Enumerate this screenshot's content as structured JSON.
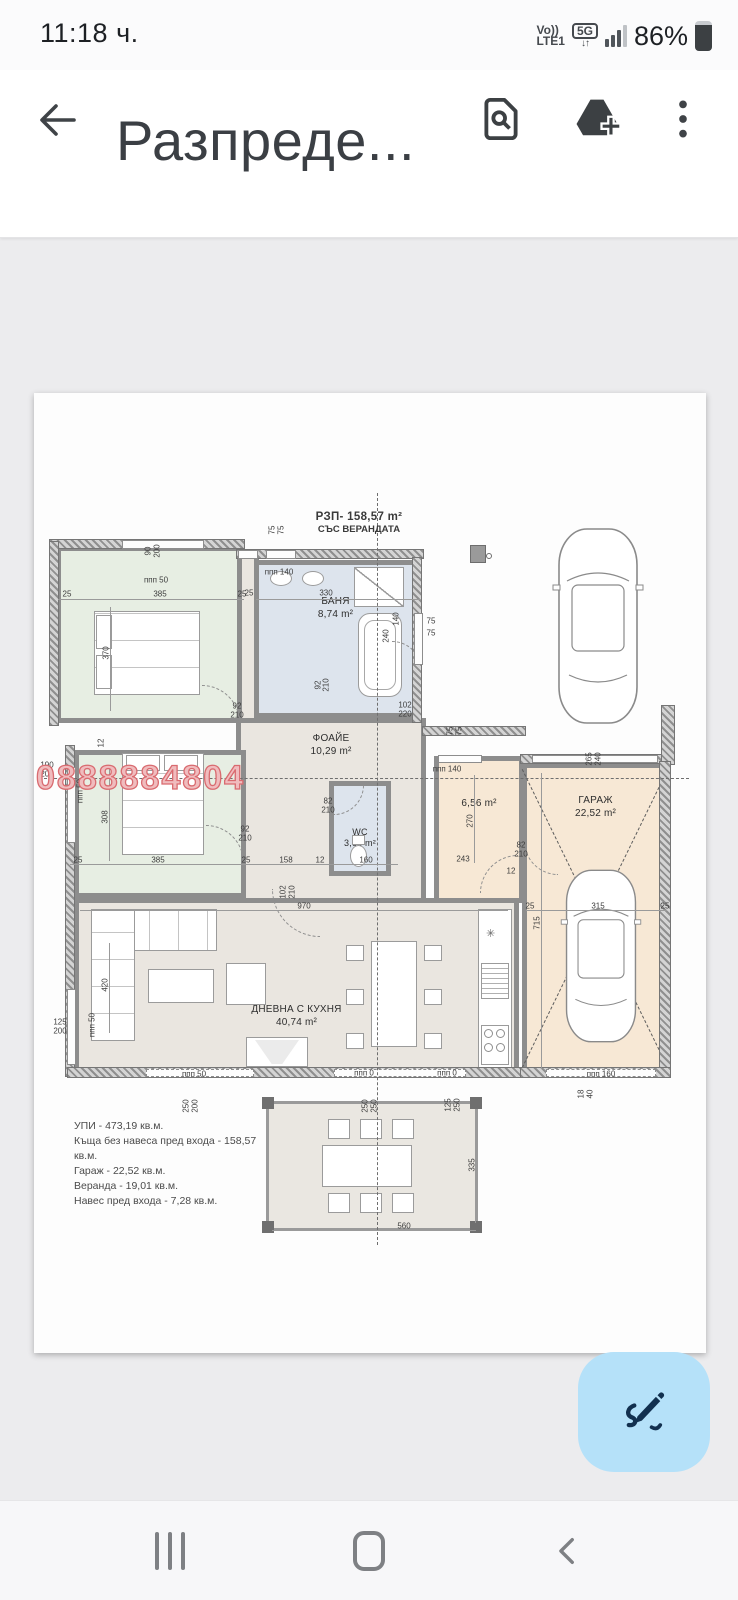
{
  "status_bar": {
    "time": "11:18 ч.",
    "carrier_top": "Vo))",
    "carrier_bottom": "LTE1",
    "network_badge": "5G",
    "updown_arrows": "↓↑",
    "battery_percent": "86%"
  },
  "header": {
    "title": "Разпреде..."
  },
  "colors": {
    "fab_accent": "#b5e1f9",
    "watermark_red": "#d96b70",
    "wall_gray": "#8d8d8d",
    "bedroom_fill": "#e7eee3",
    "bath_fill": "#dde4ed",
    "living_fill": "#eae6e0",
    "garage_fill": "#f7e8d5"
  },
  "plan": {
    "title_line1": "РЗП-  158,57 m²",
    "title_line2": "СЪС ВЕРАНДАТА",
    "watermark": "0888884804",
    "rooms": [
      {
        "id": "bedroom1",
        "lines": [
          "14,25 m²",
          "СПАЛНЯ"
        ]
      },
      {
        "id": "bath",
        "lines": [
          "БАНЯ",
          "8,74 m²"
        ]
      },
      {
        "id": "foyer",
        "lines": [
          "ФОАЙЕ",
          "10,29 m²"
        ]
      },
      {
        "id": "bedroom2",
        "lines": [
          "СПАЛНЯ",
          "11,86 m²"
        ]
      },
      {
        "id": "wc",
        "lines": [
          "WC",
          "3,68 m²"
        ]
      },
      {
        "id": "hall",
        "lines": [
          "6,56 m²"
        ]
      },
      {
        "id": "garage",
        "lines": [
          "ГАРАЖ",
          "22,52 m²"
        ]
      },
      {
        "id": "living",
        "lines": [
          "ДНЕВНА С КУХНЯ",
          "40,74 m²"
        ]
      },
      {
        "id": "veranda",
        "lines": [
          "ВЕРАНДА",
          "19,01 m²"
        ]
      }
    ],
    "summary": [
      "УПИ - 473,19 кв.м.",
      "Къща без навеса пред входа - 158,57 кв.м.",
      "Гараж - 22,52 кв.м.",
      "Веранда - 19,01 кв.м.",
      "Навес пред входа - 7,28 кв.м."
    ],
    "dims": [
      {
        "t": "90",
        "x": 114,
        "y": 158,
        "r": 1
      },
      {
        "t": "200",
        "x": 123,
        "y": 158,
        "r": 1
      },
      {
        "t": "ппп 50",
        "x": 122,
        "y": 187,
        "r": 0
      },
      {
        "t": "25",
        "x": 33,
        "y": 201,
        "r": 0
      },
      {
        "t": "385",
        "x": 126,
        "y": 201,
        "r": 0
      },
      {
        "t": "25",
        "x": 208,
        "y": 201,
        "r": 0
      },
      {
        "t": "370",
        "x": 72,
        "y": 260,
        "r": 1
      },
      {
        "t": "75",
        "x": 238,
        "y": 137,
        "r": 1
      },
      {
        "t": "75",
        "x": 247,
        "y": 137,
        "r": 1
      },
      {
        "t": "ппп 140",
        "x": 245,
        "y": 179,
        "r": 0
      },
      {
        "t": "25",
        "x": 215,
        "y": 200,
        "r": 0
      },
      {
        "t": "330",
        "x": 292,
        "y": 200,
        "r": 0
      },
      {
        "t": "75",
        "x": 397,
        "y": 228,
        "r": 0
      },
      {
        "t": "75",
        "x": 397,
        "y": 240,
        "r": 0
      },
      {
        "t": "240",
        "x": 352,
        "y": 243,
        "r": 1
      },
      {
        "t": "140",
        "x": 362,
        "y": 226,
        "r": 1
      },
      {
        "t": "92",
        "x": 284,
        "y": 292,
        "r": 1
      },
      {
        "t": "210",
        "x": 292,
        "y": 292,
        "r": 1
      },
      {
        "t": "92",
        "x": 203,
        "y": 313,
        "r": 0
      },
      {
        "t": "210",
        "x": 203,
        "y": 322,
        "r": 0
      },
      {
        "t": "102",
        "x": 371,
        "y": 312,
        "r": 0
      },
      {
        "t": "220",
        "x": 371,
        "y": 321,
        "r": 0
      },
      {
        "t": "190",
        "x": 13,
        "y": 372,
        "r": 0
      },
      {
        "t": "200",
        "x": 13,
        "y": 381,
        "r": 0
      },
      {
        "t": "12",
        "x": 67,
        "y": 350,
        "r": 1
      },
      {
        "t": "ппп 50",
        "x": 46,
        "y": 398,
        "r": 1
      },
      {
        "t": "308",
        "x": 71,
        "y": 424,
        "r": 1
      },
      {
        "t": "92",
        "x": 211,
        "y": 436,
        "r": 0
      },
      {
        "t": "210",
        "x": 211,
        "y": 445,
        "r": 0
      },
      {
        "t": "82",
        "x": 294,
        "y": 408,
        "r": 0
      },
      {
        "t": "210",
        "x": 294,
        "y": 417,
        "r": 0
      },
      {
        "t": "25",
        "x": 44,
        "y": 467,
        "r": 0
      },
      {
        "t": "385",
        "x": 124,
        "y": 467,
        "r": 0
      },
      {
        "t": "25",
        "x": 212,
        "y": 467,
        "r": 0
      },
      {
        "t": "158",
        "x": 252,
        "y": 467,
        "r": 0
      },
      {
        "t": "12",
        "x": 286,
        "y": 467,
        "r": 0
      },
      {
        "t": "160",
        "x": 332,
        "y": 467,
        "r": 0
      },
      {
        "t": "ппп 140",
        "x": 413,
        "y": 376,
        "r": 0
      },
      {
        "t": "270",
        "x": 436,
        "y": 428,
        "r": 1
      },
      {
        "t": "243",
        "x": 429,
        "y": 466,
        "r": 0
      },
      {
        "t": "82",
        "x": 487,
        "y": 452,
        "r": 0
      },
      {
        "t": "210",
        "x": 487,
        "y": 461,
        "r": 0
      },
      {
        "t": "12",
        "x": 477,
        "y": 478,
        "r": 0
      },
      {
        "t": "75",
        "x": 416,
        "y": 338,
        "r": 1
      },
      {
        "t": "75",
        "x": 425,
        "y": 338,
        "r": 1
      },
      {
        "t": "265",
        "x": 555,
        "y": 366,
        "r": 1
      },
      {
        "t": "240",
        "x": 564,
        "y": 366,
        "r": 1
      },
      {
        "t": "25",
        "x": 496,
        "y": 513,
        "r": 0
      },
      {
        "t": "315",
        "x": 564,
        "y": 513,
        "r": 0
      },
      {
        "t": "25",
        "x": 631,
        "y": 513,
        "r": 0
      },
      {
        "t": "715",
        "x": 503,
        "y": 530,
        "r": 1
      },
      {
        "t": "970",
        "x": 270,
        "y": 513,
        "r": 0
      },
      {
        "t": "102",
        "x": 249,
        "y": 499,
        "r": 1
      },
      {
        "t": "210",
        "x": 258,
        "y": 499,
        "r": 1
      },
      {
        "t": "420",
        "x": 71,
        "y": 592,
        "r": 1
      },
      {
        "t": "125",
        "x": 26,
        "y": 629,
        "r": 0
      },
      {
        "t": "200",
        "x": 26,
        "y": 638,
        "r": 0
      },
      {
        "t": "ппп 50",
        "x": 58,
        "y": 632,
        "r": 1
      },
      {
        "t": "ппп 50",
        "x": 160,
        "y": 681,
        "r": 0
      },
      {
        "t": "ппп 0",
        "x": 330,
        "y": 680,
        "r": 0
      },
      {
        "t": "ппп 0",
        "x": 413,
        "y": 680,
        "r": 0
      },
      {
        "t": "ппп 160",
        "x": 567,
        "y": 681,
        "r": 0
      },
      {
        "t": "250",
        "x": 152,
        "y": 713,
        "r": 1
      },
      {
        "t": "200",
        "x": 161,
        "y": 713,
        "r": 1
      },
      {
        "t": "250",
        "x": 331,
        "y": 713,
        "r": 1
      },
      {
        "t": "250",
        "x": 340,
        "y": 713,
        "r": 1
      },
      {
        "t": "125",
        "x": 414,
        "y": 712,
        "r": 1
      },
      {
        "t": "250",
        "x": 423,
        "y": 712,
        "r": 1
      },
      {
        "t": "18",
        "x": 547,
        "y": 701,
        "r": 1
      },
      {
        "t": "40",
        "x": 556,
        "y": 701,
        "r": 1
      },
      {
        "t": "335",
        "x": 438,
        "y": 772,
        "r": 1
      },
      {
        "t": "560",
        "x": 370,
        "y": 833,
        "r": 0
      }
    ]
  }
}
